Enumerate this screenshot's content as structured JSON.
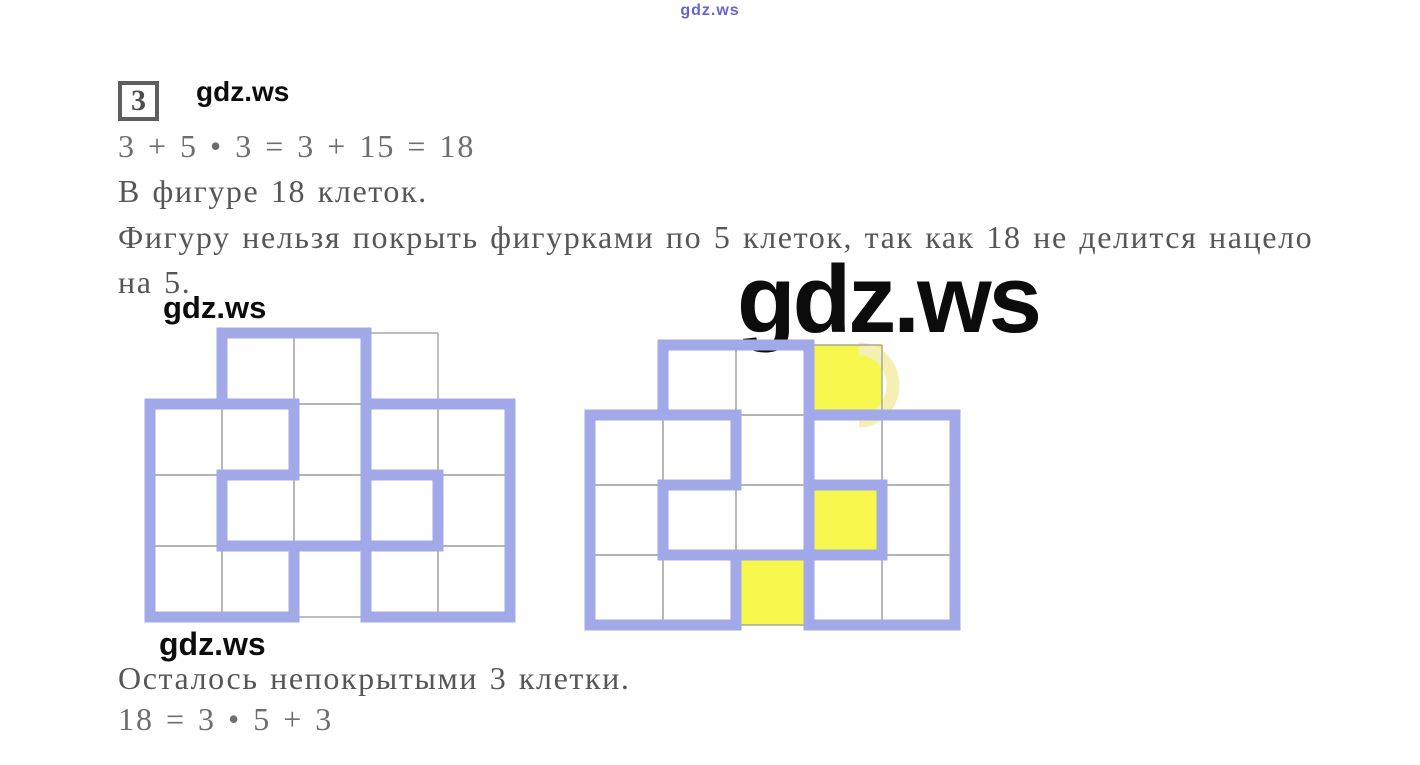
{
  "watermarks": {
    "top_small": "gdz.ws",
    "inline_1": "gdz.ws",
    "inline_2": "gdz.ws",
    "inline_3": "gdz.ws",
    "large": "gdz.ws"
  },
  "problem": {
    "number": "3"
  },
  "solution": {
    "equation1": "3 + 5 • 3 = 3 + 15 = 18",
    "cells_total": "В фигуре 18 клеток.",
    "explanation_line1": "Фигуру нельзя покрыть фигурками по 5 клеток, так как 18 не делится нацело",
    "explanation_line2": "на 5.",
    "uncovered_note": "Осталось непокрытыми 3 клетки.",
    "equation2": "18 = 3 • 5 + 3"
  },
  "figures": {
    "colors": {
      "piece_outline": "#a2a9e8",
      "grid_line": "#969696",
      "uncovered_fill": "#f7f74d",
      "artifact": "#f4efb2"
    },
    "grid": {
      "rows": 4,
      "cols": 5,
      "missing_cells": [
        [
          1,
          1
        ],
        [
          1,
          5
        ]
      ]
    },
    "pieces": [
      {
        "name": "piece-left-P",
        "cells": [
          [
            2,
            1
          ],
          [
            2,
            2
          ],
          [
            3,
            1
          ],
          [
            4,
            1
          ],
          [
            4,
            2
          ]
        ]
      },
      {
        "name": "piece-top-Z",
        "cells": [
          [
            1,
            2
          ],
          [
            1,
            3
          ],
          [
            2,
            3
          ],
          [
            3,
            2
          ],
          [
            3,
            3
          ]
        ]
      },
      {
        "name": "piece-right-U",
        "cells": [
          [
            2,
            4
          ],
          [
            2,
            5
          ],
          [
            3,
            5
          ],
          [
            4,
            4
          ],
          [
            4,
            5
          ]
        ]
      }
    ],
    "uncovered_cells": [
      [
        1,
        4
      ],
      [
        3,
        4
      ],
      [
        4,
        3
      ]
    ],
    "left_figure": {
      "cell_w": 72,
      "cell_h": 71,
      "width": 384,
      "height": 308,
      "highlight_uncovered": false,
      "artifact": false
    },
    "right_figure": {
      "cell_w": 73,
      "cell_h": 70,
      "width": 389,
      "height": 304,
      "highlight_uncovered": true,
      "artifact": true
    }
  }
}
